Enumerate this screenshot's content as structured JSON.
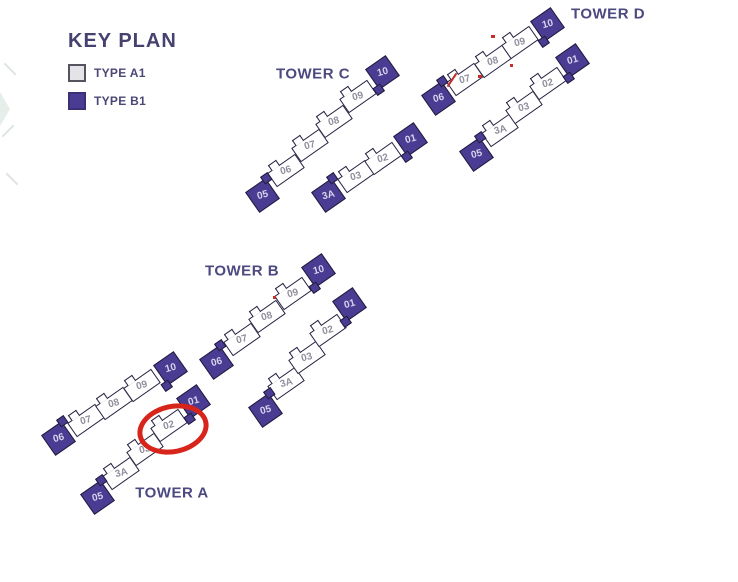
{
  "legend": {
    "title": "KEY PLAN",
    "items": [
      {
        "id": "A1",
        "label": "TYPE A1",
        "swatch_fill": "#e4e4e8",
        "swatch_border": "#55545e"
      },
      {
        "id": "B1",
        "label": "TYPE B1",
        "swatch_fill": "#4a3c93",
        "swatch_border": "#3b2f75"
      }
    ]
  },
  "colors": {
    "unit_type_a1_fill": "#ffffff",
    "unit_type_b1_fill": "#4a3c93",
    "unit_outline": "#262242",
    "unit_label_on_a1": "#8f8f9e",
    "unit_label_on_b1": "#d7d3ea",
    "heading_text": "#45426f",
    "tower_label_text": "#4c4880",
    "highlight_red": "#d8251b"
  },
  "towers": [
    {
      "name": "TOWER A",
      "rows": [
        [
          {
            "label": "06",
            "type": "B1"
          },
          {
            "label": "07",
            "type": "A1"
          },
          {
            "label": "08",
            "type": "A1"
          },
          {
            "label": "09",
            "type": "A1"
          },
          {
            "label": "10",
            "type": "B1"
          }
        ],
        [
          {
            "label": "05",
            "type": "B1"
          },
          {
            "label": "3A",
            "type": "A1"
          },
          {
            "label": "03",
            "type": "A1"
          },
          {
            "label": "02",
            "type": "A1"
          },
          {
            "label": "01",
            "type": "B1"
          }
        ]
      ]
    },
    {
      "name": "TOWER B",
      "rows": [
        [
          {
            "label": "06",
            "type": "B1"
          },
          {
            "label": "07",
            "type": "A1"
          },
          {
            "label": "08",
            "type": "A1"
          },
          {
            "label": "09",
            "type": "A1"
          },
          {
            "label": "10",
            "type": "B1"
          }
        ],
        [
          {
            "label": "05",
            "type": "B1"
          },
          {
            "label": "3A",
            "type": "A1"
          },
          {
            "label": "03",
            "type": "A1"
          },
          {
            "label": "02",
            "type": "A1"
          },
          {
            "label": "01",
            "type": "B1"
          }
        ]
      ]
    },
    {
      "name": "TOWER C",
      "rows": [
        [
          {
            "label": "05",
            "type": "B1"
          },
          {
            "label": "06",
            "type": "A1"
          },
          {
            "label": "07",
            "type": "A1"
          },
          {
            "label": "08",
            "type": "A1"
          },
          {
            "label": "09",
            "type": "A1"
          },
          {
            "label": "10",
            "type": "B1"
          }
        ],
        [
          {
            "label": "3A",
            "type": "B1"
          },
          {
            "label": "03",
            "type": "A1"
          },
          {
            "label": "02",
            "type": "A1"
          },
          {
            "label": "01",
            "type": "B1"
          }
        ]
      ]
    },
    {
      "name": "TOWER D",
      "rows": [
        [
          {
            "label": "06",
            "type": "B1"
          },
          {
            "label": "07",
            "type": "A1"
          },
          {
            "label": "08",
            "type": "A1"
          },
          {
            "label": "09",
            "type": "A1"
          },
          {
            "label": "10",
            "type": "B1"
          }
        ],
        [
          {
            "label": "05",
            "type": "B1"
          },
          {
            "label": "3A",
            "type": "A1"
          },
          {
            "label": "03",
            "type": "A1"
          },
          {
            "label": "02",
            "type": "A1"
          },
          {
            "label": "01",
            "type": "B1"
          }
        ]
      ]
    }
  ],
  "highlight": {
    "tower": "TOWER A",
    "unit": "02"
  }
}
